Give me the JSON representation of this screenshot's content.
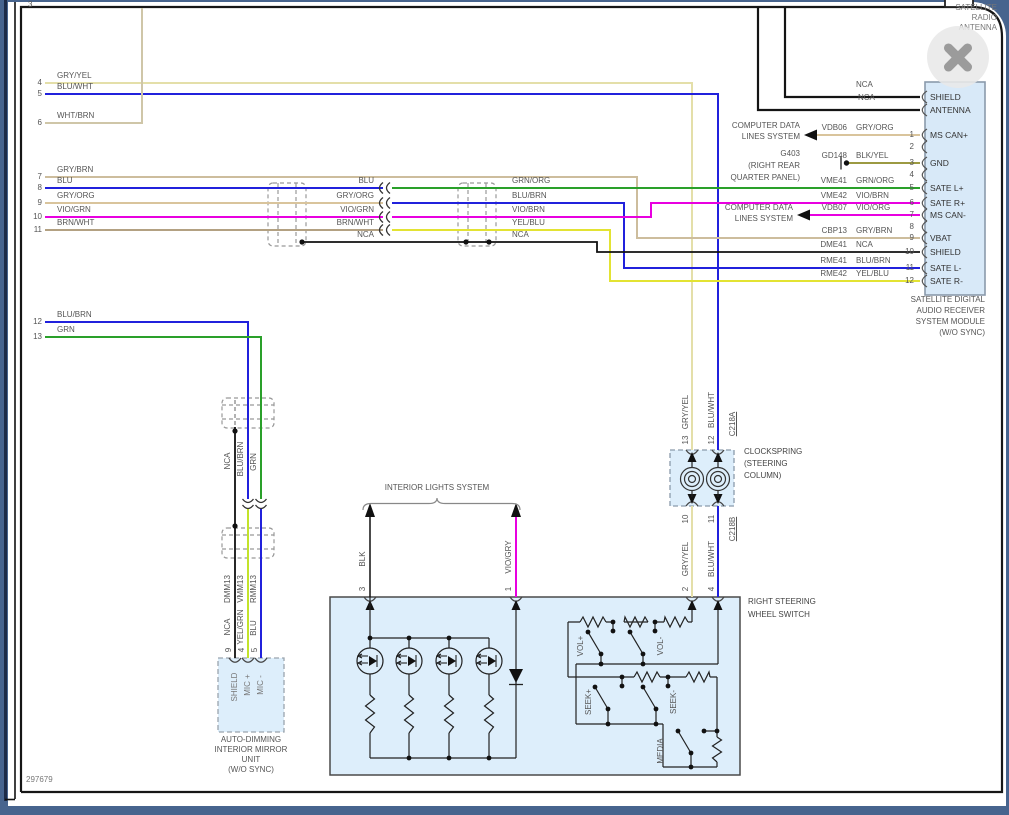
{
  "page": {
    "sheet_number": "297679",
    "top_wire_number": "3"
  },
  "colors": {
    "blue": "#2121dc",
    "green": "#2aa02a",
    "magenta": "#e800e0",
    "yellow": "#e3e333",
    "yellow_green": "#c3e32a",
    "tan": "#cdbd9d",
    "pale_yellow": "#e4dfa9",
    "light_tan": "#cfc6a8",
    "dark_tan": "#b3a182",
    "gry_org_tan": "#d9c49c",
    "olive": "#9c9a42",
    "black_wire": "#111111",
    "box_fill": "#ddeefb",
    "module_fill": "#d8e9f8"
  },
  "antenna": {
    "title1": "SATELLITE",
    "title2": "RADIO",
    "title3": "ANTENNA",
    "wire1": "NCA",
    "wire2": "NCA"
  },
  "module": {
    "caption1": "SATELLITE DIGITAL",
    "caption2": "AUDIO RECEIVER",
    "caption3": "SYSTEM MODULE",
    "caption4": "(W/O SYNC)",
    "pins": {
      "shield_top": "SHIELD",
      "antenna": "ANTENNA",
      "p1": "MS CAN+",
      "p3": "GND",
      "p5": "SATE L+",
      "p6": "SATE R+",
      "p7": "MS CAN-",
      "p9": "VBAT",
      "p10": "SHIELD",
      "p11": "SATE L-",
      "p12": "SATE R-"
    },
    "pin_numbers": [
      "1",
      "2",
      "3",
      "4",
      "5",
      "6",
      "7",
      "8",
      "9",
      "10",
      "11",
      "12"
    ],
    "wires": {
      "w1": {
        "code": "VDB06",
        "color": "GRY/ORG"
      },
      "w3": {
        "code": "GD148",
        "color": "BLK/YEL"
      },
      "w5": {
        "code": "VME41",
        "color": "GRN/ORG"
      },
      "w6": {
        "code": "VME42",
        "color": "VIO/BRN"
      },
      "w7": {
        "code": "VDB07",
        "color": "VIO/ORG"
      },
      "w9": {
        "code": "CBP13",
        "color": "GRY/BRN"
      },
      "w10": {
        "code": "DME41",
        "color": "NCA"
      },
      "w11": {
        "code": "RME41",
        "color": "BLU/BRN"
      },
      "w12": {
        "code": "RME42",
        "color": "YEL/BLU"
      }
    }
  },
  "refs": {
    "cdl1a": "COMPUTER DATA",
    "cdl1b": "LINES SYSTEM",
    "ground_name": "G403",
    "ground_loc1": "(RIGHT REAR",
    "ground_loc2": "QUARTER PANEL)",
    "cdl2a": "COMPUTER DATA",
    "cdl2b": "LINES SYSTEM"
  },
  "left_rows": {
    "n4": "4",
    "l4": "GRY/YEL",
    "n5": "5",
    "l5": "BLU/WHT",
    "n6": "6",
    "l6": "WHT/BRN",
    "n7": "7",
    "l7": "GRY/BRN",
    "n8": "8",
    "l8": "BLU",
    "n9": "9",
    "l9": "GRY/ORG",
    "n10": "10",
    "l10": "VIO/GRN",
    "n11": "11",
    "l11": "BRN/WHT",
    "n12": "12",
    "l12": "BLU/BRN",
    "n13": "13",
    "l13": "GRN"
  },
  "mid_left": {
    "r8": "BLU",
    "r9": "GRY/ORG",
    "r10": "VIO/GRN",
    "r11": "BRN/WHT",
    "rn": "NCA"
  },
  "mid_right": {
    "r8": "GRN/ORG",
    "r9": "BLU/BRN",
    "r10": "VIO/BRN",
    "r11": "YEL/BLU",
    "rn": "NCA"
  },
  "clockspring": {
    "caption1": "CLOCKSPRING",
    "caption2": "(STEERING",
    "caption3": "COLUMN)",
    "conn_top": "C218A",
    "conn_bottom": "C218B",
    "pin13": "13",
    "pin12": "12",
    "pin10": "10",
    "pin11": "11",
    "wire_gry_yel": "GRY/YEL",
    "wire_blu_wht": "BLU/WHT",
    "lower_gry_yel": "GRY/YEL",
    "lower_blu_wht": "BLU/WHT",
    "pin2": "2",
    "pin4": "4"
  },
  "interior_lights": {
    "label": "INTERIOR LIGHTS SYSTEM",
    "pin3": "3",
    "wire3": "BLK",
    "pin1": "1",
    "wire1": "VIO/GRY"
  },
  "switch": {
    "caption1": "RIGHT STEERING",
    "caption2": "WHEEL SWITCH",
    "vol_plus": "VOL+",
    "vol_minus": "VOL-",
    "seek_plus": "SEEK+",
    "seek_minus": "SEEK-",
    "media": "MEDIA"
  },
  "mirror": {
    "upper_nca": "NCA",
    "upper_blu_brn": "BLU/BRN",
    "upper_grn": "GRN",
    "code_d": "DMM13",
    "code_v": "VMM13",
    "code_r": "RMM13",
    "lower_nca": "NCA",
    "lower_yel_grn": "YEL/GRN",
    "lower_blu": "BLU",
    "pin9": "9",
    "pin4": "4",
    "pin5": "5",
    "box_shield": "SHIELD",
    "box_mic_p": "MIC +",
    "box_mic_m": "MIC -",
    "caption1": "AUTO-DIMMING",
    "caption2": "INTERIOR MIRROR",
    "caption3": "UNIT",
    "caption4": "(W/O SYNC)"
  }
}
